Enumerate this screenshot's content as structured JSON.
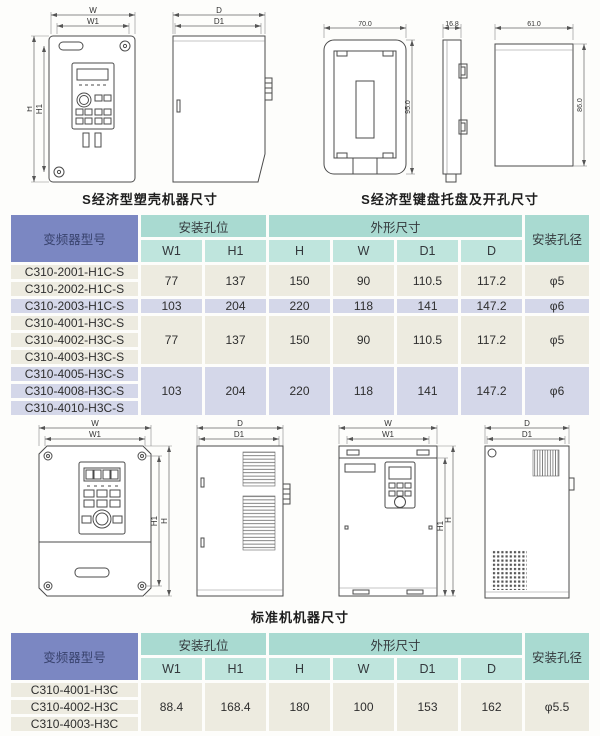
{
  "captions": {
    "top_left": "S经济型塑壳机器尺寸",
    "top_right": "S经济型键盘托盘及开孔尺寸",
    "middle": "标准机机器尺寸"
  },
  "dims": {
    "w": "W",
    "w1": "W1",
    "h": "H",
    "h1": "H1",
    "d": "D",
    "d1": "D1",
    "tray_width": "70.0",
    "tray_height": "95.0",
    "tray_depth": "16.8",
    "cutout_width": "61.0",
    "cutout_height": "86.0"
  },
  "colors": {
    "model_header_bg": "#7b87c2",
    "group_header_bg": "#a9dad1",
    "col_header_bg": "#bfe5dd",
    "row_beige": "#edebe0",
    "row_lavender": "#d4d7e9"
  },
  "table1": {
    "header": {
      "model": "变频器型号",
      "mounting": "安装孔位",
      "outline": "外形尺寸",
      "hole_dia": "安装孔径",
      "columns": [
        "W1",
        "H1",
        "H",
        "W",
        "D1",
        "D"
      ]
    },
    "groups": [
      {
        "tone": "beige",
        "models": [
          "C310-2001-H1C-S",
          "C310-2002-H1C-S"
        ],
        "values": [
          "77",
          "137",
          "150",
          "90",
          "110.5",
          "117.2",
          "φ5"
        ]
      },
      {
        "tone": "lavender",
        "models": [
          "C310-2003-H1C-S"
        ],
        "values": [
          "103",
          "204",
          "220",
          "118",
          "141",
          "147.2",
          "φ6"
        ]
      },
      {
        "tone": "beige",
        "models": [
          "C310-4001-H3C-S",
          "C310-4002-H3C-S",
          "C310-4003-H3C-S"
        ],
        "values": [
          "77",
          "137",
          "150",
          "90",
          "110.5",
          "117.2",
          "φ5"
        ]
      },
      {
        "tone": "lavender",
        "models": [
          "C310-4005-H3C-S",
          "C310-4008-H3C-S",
          "C310-4010-H3C-S"
        ],
        "values": [
          "103",
          "204",
          "220",
          "118",
          "141",
          "147.2",
          "φ6"
        ]
      }
    ]
  },
  "table2": {
    "header": {
      "model": "变频器型号",
      "mounting": "安装孔位",
      "outline": "外形尺寸",
      "hole_dia": "安装孔径",
      "columns": [
        "W1",
        "H1",
        "H",
        "W",
        "D1",
        "D"
      ]
    },
    "groups": [
      {
        "tone": "beige",
        "models": [
          "C310-4001-H3C",
          "C310-4002-H3C",
          "C310-4003-H3C"
        ],
        "values": [
          "88.4",
          "168.4",
          "180",
          "100",
          "153",
          "162",
          "φ5.5"
        ]
      }
    ]
  }
}
